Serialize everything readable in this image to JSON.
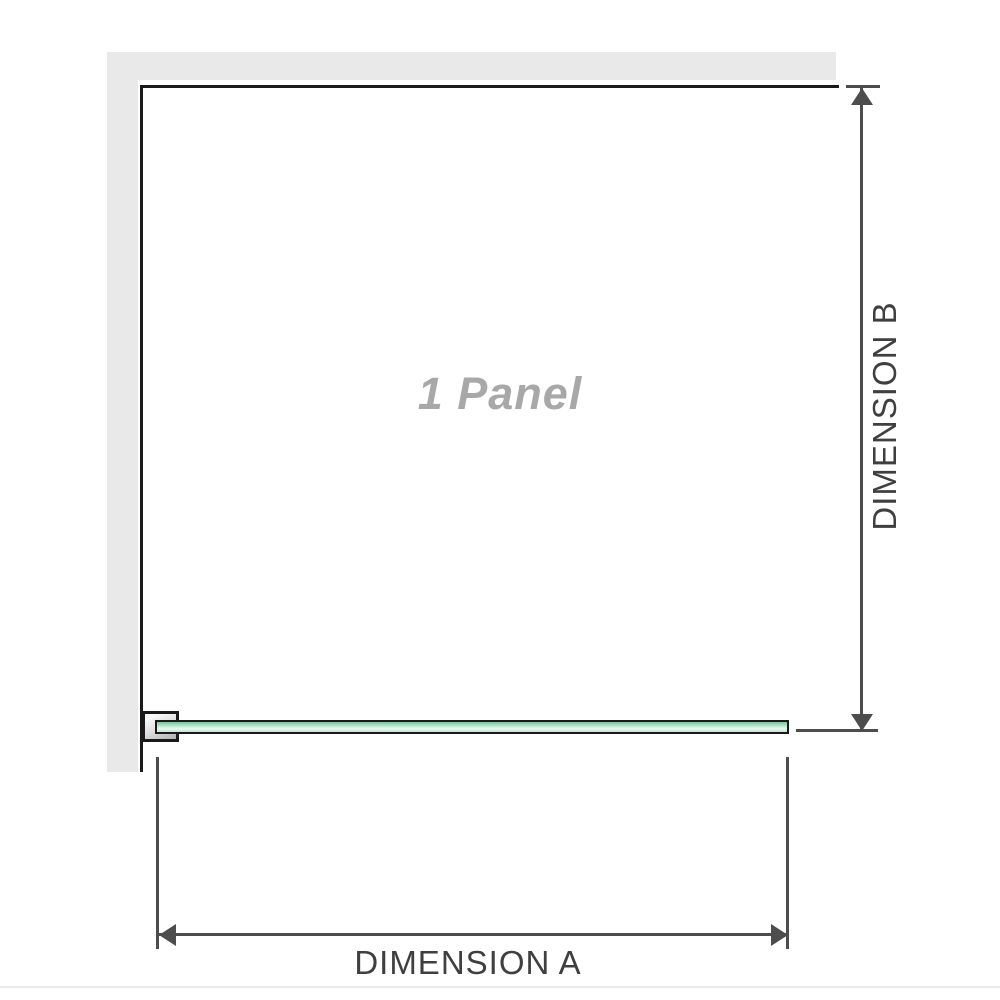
{
  "diagram": {
    "panel_label": "1 Panel",
    "dimension_a": {
      "label": "DIMENSION A",
      "axis": "horizontal"
    },
    "dimension_b": {
      "label": "DIMENSION B",
      "axis": "vertical"
    },
    "colors": {
      "wall_gray": "#e9e9e9",
      "outline_black": "#1a1a1a",
      "dimension_gray": "#4d4d4d",
      "dimension_label_text": "#3f3f3f",
      "panel_label_gray": "#a8a8a8",
      "glass_green_dark": "#79c498",
      "glass_green_light": "#e8f8ef",
      "bracket_silver": "#b5b5b5",
      "baseline_light": "#e8ebee"
    },
    "icons": {
      "arrow_up": "css-triangle",
      "arrow_down": "css-triangle",
      "arrow_left": "css-triangle",
      "arrow_right": "css-triangle"
    }
  }
}
